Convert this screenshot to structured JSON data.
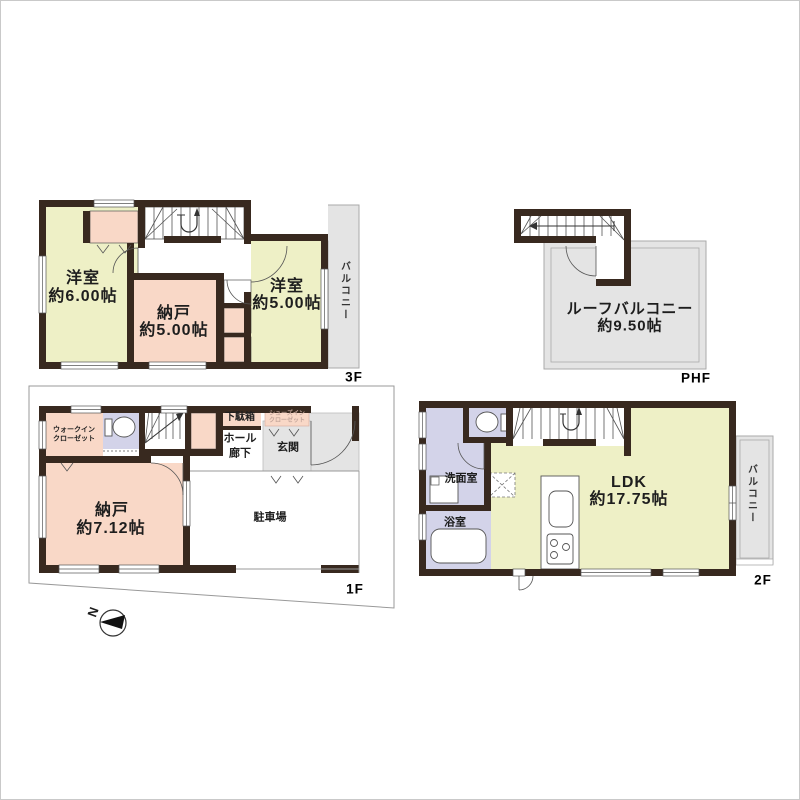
{
  "palette": {
    "wall": "#38291f",
    "room_yellow": "#eef0c6",
    "room_pink": "#f9d8c7",
    "room_purple": "#d3d3e9",
    "area_gray": "#e4e4e4",
    "thin_line": "#555555"
  },
  "floors": {
    "f3": {
      "floor_label": "3F",
      "rooms": {
        "western6": {
          "name": "洋室",
          "area": "約6.00帖"
        },
        "storage5": {
          "name": "納戸",
          "area": "約5.00帖"
        },
        "western5": {
          "name": "洋室",
          "area": "約5.00帖"
        },
        "balcony": {
          "name": "バルコニー"
        }
      }
    },
    "phf": {
      "floor_label": "PHF",
      "rooms": {
        "roof_balcony": {
          "name": "ルーフバルコニー",
          "area": "約9.50帖"
        }
      }
    },
    "f2": {
      "floor_label": "2F",
      "rooms": {
        "washroom": {
          "name": "洗面室"
        },
        "bathroom": {
          "name": "浴室"
        },
        "ldk": {
          "name": "LDK",
          "area": "約17.75帖"
        },
        "balcony": {
          "name": "バルコニー"
        }
      }
    },
    "f1": {
      "floor_label": "1F",
      "rooms": {
        "walk_in_closet": {
          "line1": "ウォークイン",
          "line2": "クローゼット"
        },
        "shoe_cabinet": {
          "name": "下駄箱"
        },
        "shoes_in_closet": {
          "line1": "シューズイン",
          "line2": "クローゼット"
        },
        "hall_corridor": {
          "line1": "ホール",
          "line2": "廊下"
        },
        "entrance": {
          "name": "玄関"
        },
        "storage7": {
          "name": "納戸",
          "area": "約7.12帖"
        },
        "parking": {
          "name": "駐車場"
        }
      },
      "compass": {
        "north_label": "N"
      }
    }
  }
}
